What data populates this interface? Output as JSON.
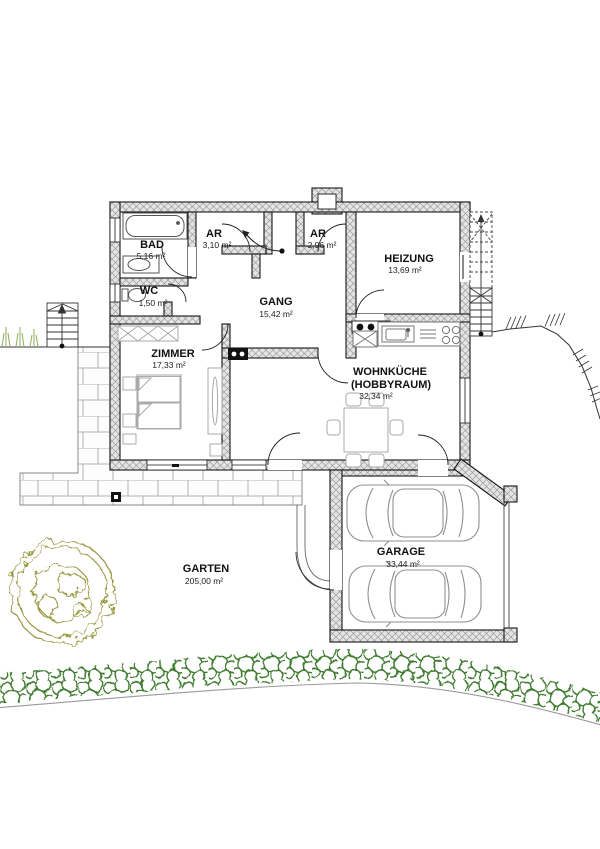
{
  "rooms": {
    "bad": {
      "name": "BAD",
      "area": "5,16 m²"
    },
    "wc": {
      "name": "WC",
      "area": "1,50 m²"
    },
    "ar1": {
      "name": "AR",
      "area": "3,10 m²"
    },
    "ar2": {
      "name": "AR",
      "area": "2,96 m²"
    },
    "heizung": {
      "name": "HEIZUNG",
      "area": "13,69 m²"
    },
    "gang": {
      "name": "GANG",
      "area": "15,42 m²"
    },
    "zimmer": {
      "name": "ZIMMER",
      "area": "17,33 m²"
    },
    "wohnkueche": {
      "name": "WOHNKÜCHE",
      "sub": "(HOBBYRAUM)",
      "area": "32,34 m²"
    },
    "garage": {
      "name": "GARAGE",
      "area": "33,44 m²"
    },
    "garten": {
      "name": "GARTEN",
      "area": "205,00 m²"
    }
  },
  "colors": {
    "wall_fill": "#e4e4e4",
    "wall_hatch": "#9c9c9c",
    "outline": "#161616",
    "hedge_green": "#3e7a2e",
    "tree_olive": "#9a9941",
    "grass_green": "#8fae5c",
    "brick_joint": "#b4b4b4",
    "car_gray": "#8f8f8f"
  }
}
